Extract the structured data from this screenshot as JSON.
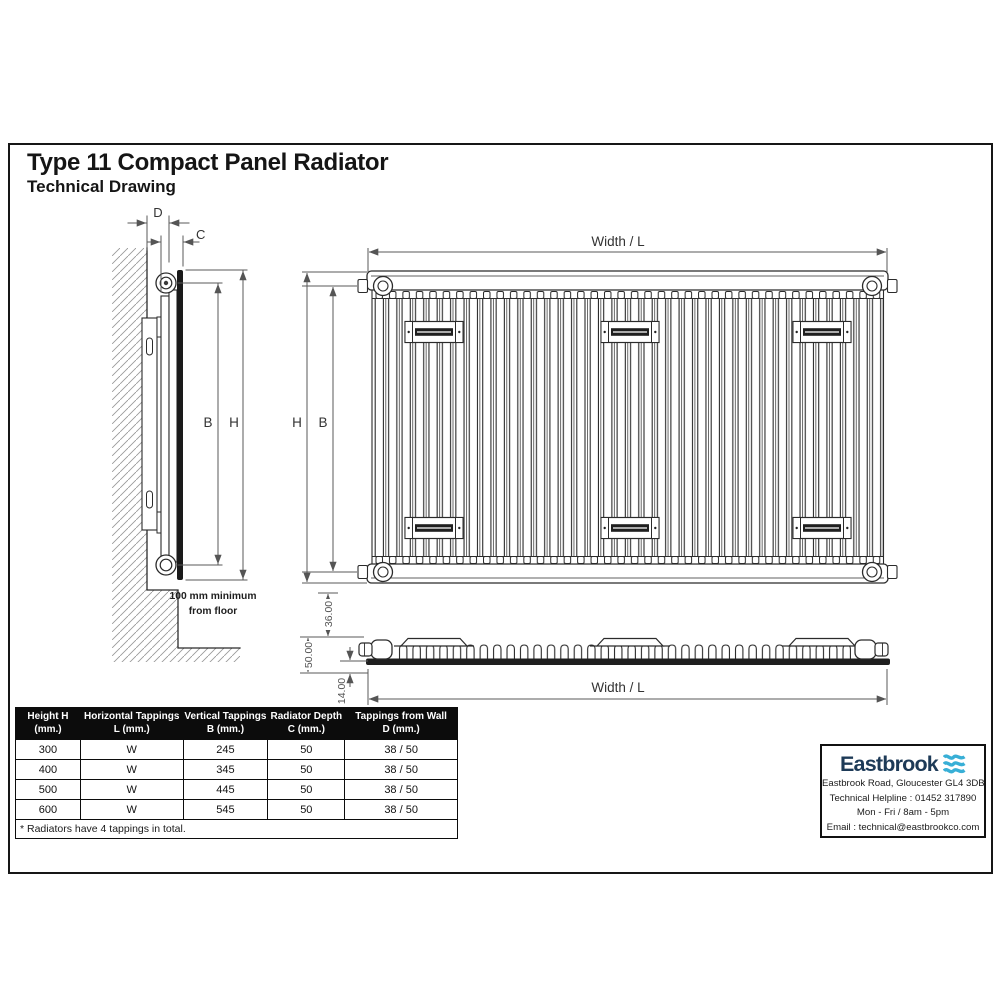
{
  "page": {
    "title": "Type 11 Compact Panel Radiator",
    "subtitle": "Technical Drawing"
  },
  "drawing": {
    "side_view": {
      "dim_d": "D",
      "dim_c": "C",
      "dim_b": "B",
      "dim_h": "H",
      "floor_note_line1": "100 mm minimum",
      "floor_note_line2": "from floor"
    },
    "front_view": {
      "dim_width": "Width / L",
      "dim_h": "H",
      "dim_b": "B"
    },
    "top_view": {
      "dim_depth_top": "36.00",
      "dim_depth_total": "50.00",
      "dim_panel": "14.00",
      "dim_width": "Width / L"
    }
  },
  "spec_table": {
    "headers": [
      {
        "line1": "Height H",
        "line2": "(mm.)"
      },
      {
        "line1": "Horizontal Tappings",
        "line2": "L (mm.)"
      },
      {
        "line1": "Vertical Tappings",
        "line2": "B (mm.)"
      },
      {
        "line1": "Radiator Depth",
        "line2": "C (mm.)"
      },
      {
        "line1": "Tappings from Wall",
        "line2": "D (mm.)"
      }
    ],
    "rows": [
      {
        "cells": [
          "300",
          "W",
          "245",
          "50",
          "38 / 50"
        ]
      },
      {
        "cells": [
          "400",
          "W",
          "345",
          "50",
          "38 / 50"
        ]
      },
      {
        "cells": [
          "500",
          "W",
          "445",
          "50",
          "38 / 50"
        ]
      },
      {
        "cells": [
          "600",
          "W",
          "545",
          "50",
          "38 / 50"
        ]
      }
    ],
    "footnote": "* Radiators have 4 tappings in total."
  },
  "company": {
    "name": "Eastbrook",
    "address": "Eastbrook Road, Gloucester GL4 3DB",
    "helpline": "Technical Helpline : 01452 317890",
    "hours": "Mon - Fri / 8am - 5pm",
    "email": "Email : technical@eastbrookco.com",
    "brand_navy": "#1d3a57",
    "brand_cyan": "#38afd6"
  }
}
